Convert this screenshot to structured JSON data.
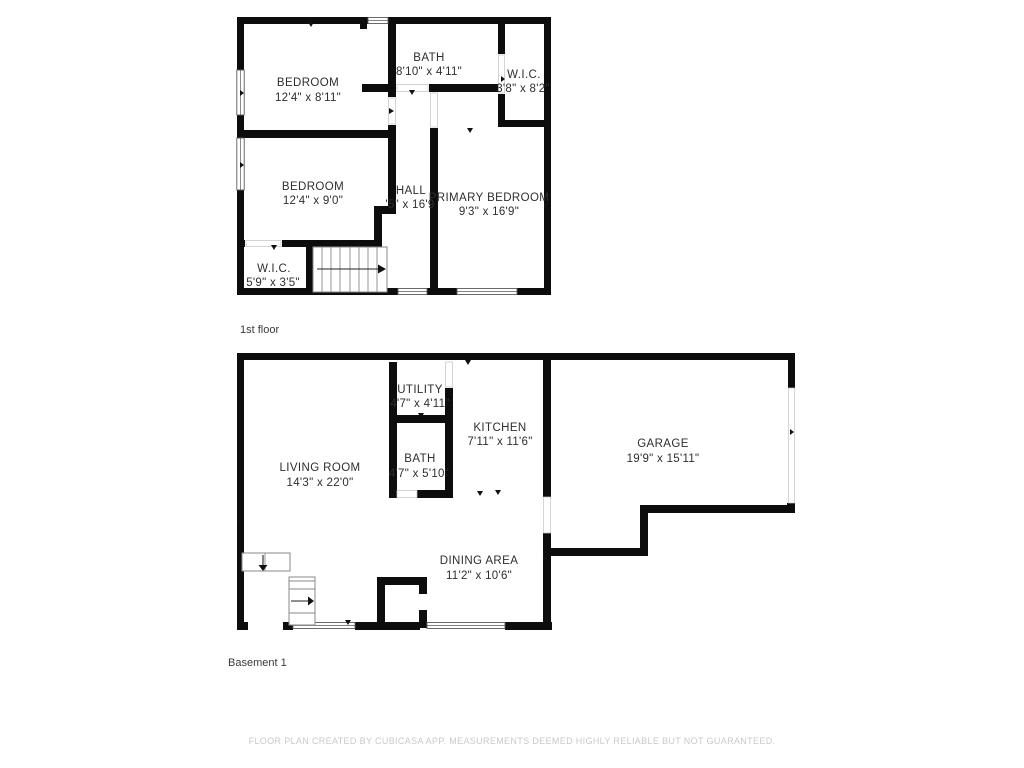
{
  "floors": [
    {
      "label": "1st floor",
      "rooms": [
        {
          "name": "BEDROOM",
          "dims": "12'4\" x 8'11\""
        },
        {
          "name": "BATH",
          "dims": "8'10\" x 4'11\""
        },
        {
          "name": "W.I.C.",
          "dims": "3'8\" x 8'2\""
        },
        {
          "name": "BEDROOM",
          "dims": "12'4\" x 9'0\""
        },
        {
          "name": "HALL",
          "dims": "'5\" x 16'9"
        },
        {
          "name": "PRIMARY BEDROOM",
          "dims": "9'3\" x 16'9\""
        },
        {
          "name": "W.I.C.",
          "dims": "5'9\" x 3'5\""
        }
      ]
    },
    {
      "label": "Basement 1",
      "rooms": [
        {
          "name": "LIVING ROOM",
          "dims": "14'3\" x 22'0\""
        },
        {
          "name": "UTILITY",
          "dims": "4'7\" x 4'11\""
        },
        {
          "name": "BATH",
          "dims": "4'7\" x 5'10\""
        },
        {
          "name": "KITCHEN",
          "dims": "7'11\" x 11'6\""
        },
        {
          "name": "DINING AREA",
          "dims": "11'2\" x 10'6\""
        },
        {
          "name": "GARAGE",
          "dims": "19'9\" x 15'11\""
        }
      ]
    }
  ],
  "footer": "FLOOR PLAN CREATED BY CUBICASA APP. MEASUREMENTS DEEMED HIGHLY RELIABLE BUT NOT GUARANTEED."
}
